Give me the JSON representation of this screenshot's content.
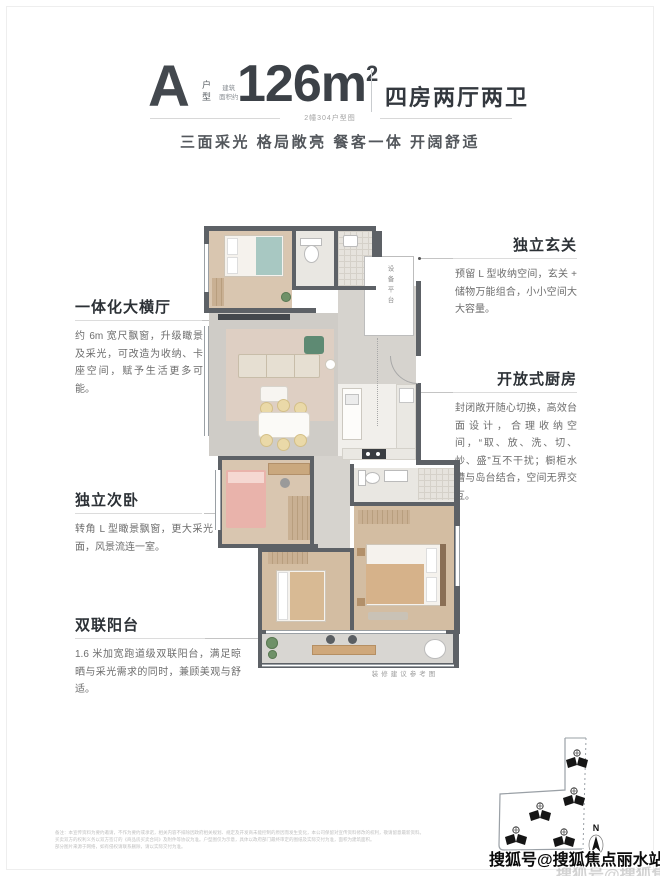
{
  "header": {
    "type_letter": "A",
    "type_label": "户型",
    "area_prefix_top": "建筑",
    "area_prefix_bottom": "面积约",
    "area_value": "126m",
    "area_sup": "2",
    "rooms_label": "四房两厅两卫",
    "sub_caption": "2幢304户型图",
    "slogan": "三面采光 格局敞亮 餐客一体 开阔舒适"
  },
  "callouts_left": [
    {
      "title": "一体化大横厅",
      "body": "约 6m 宽尺飘窗，升级瞰景及采光，可改造为收纳、卡座空间，赋予生活更多可能。"
    },
    {
      "title": "独立次卧",
      "body": "转角 L 型瞰景飘窗，更大采光面，风景流连一室。"
    },
    {
      "title": "双联阳台",
      "body": "1.6 米加宽跑道级双联阳台，满足晾晒与采光需求的同时，兼顾美观与舒适。"
    }
  ],
  "callouts_right": [
    {
      "title": "独立玄关",
      "body": "预留 L 型收纳空间，玄关 + 储物万能组合，小小空间大大容量。"
    },
    {
      "title": "开放式厨房",
      "body": "封闭敞开随心切换，高效台面设计，合理收纳空间，“取、放、洗、切、炒、盛”互不干扰；橱柜水槽与岛台结合，空间无界交互。"
    }
  ],
  "plan": {
    "platform_label": "设备平台",
    "caption": "装修建议参考图"
  },
  "site_plan": {
    "north_label": "N"
  },
  "footer": {
    "line1": "备注：本宣传资料为要约邀请，不作为要约或承诺，相关内容不排除因政府相关规划、规定及开发商未能控制的原因而发生变化，本公司保留对宣传资料修改的权利，敬请留意最新资料。",
    "line2": "买卖双方的权利义务以双方签订的《商品房买卖合同》及附件等协议为准。户型图仅为示意，具体以政府部门最终审定的图纸及实际交付为准，面积为建筑面积。",
    "line3": "部分图片来源于网络，如有侵权请联系删除，请以实际交付为准。"
  },
  "watermark": {
    "text": "搜狐号@搜狐焦点丽水站"
  },
  "colors": {
    "wall": "#5d6166",
    "wood_floor": "#d9c6b0",
    "sofa_green": "#5e8a73",
    "bed_pink": "#e9b3ab",
    "title_dark": "#33383e"
  }
}
